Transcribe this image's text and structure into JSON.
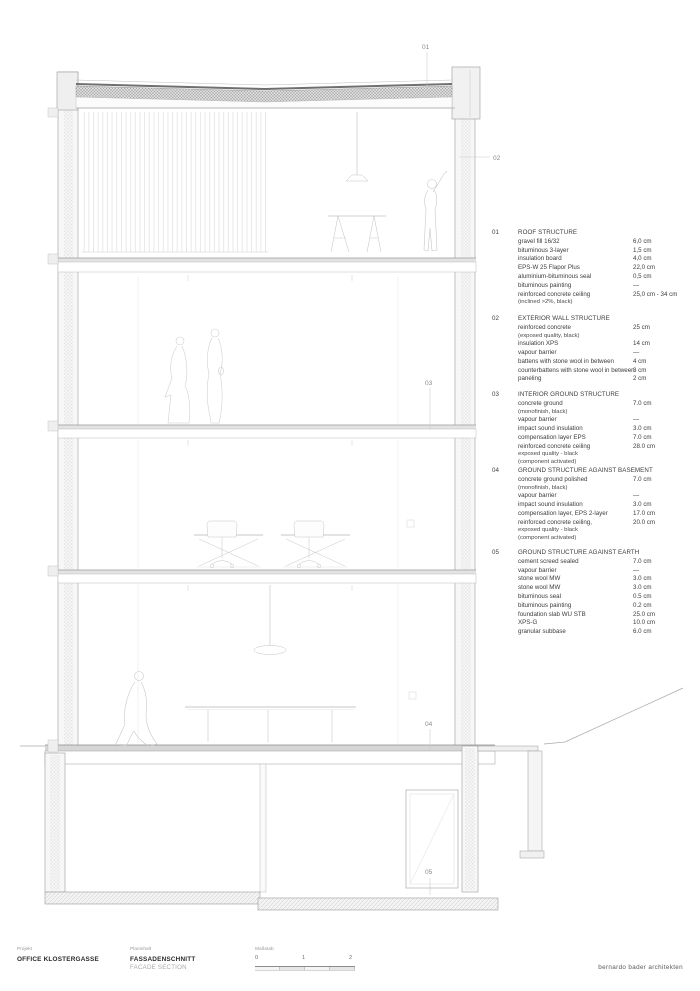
{
  "palette": {
    "ink": "#3a3a3a",
    "line_light": "#c9c9c9",
    "line_mid": "#9b9b9b",
    "slab_fill": "#d6d6d6",
    "roof_fill": "#dcdcdc"
  },
  "drawing": {
    "markers": [
      {
        "id": "01"
      },
      {
        "id": "02"
      },
      {
        "id": "03"
      },
      {
        "id": "04"
      },
      {
        "id": "05"
      }
    ]
  },
  "notes": [
    {
      "number": "01",
      "title": "ROOF STRUCTURE",
      "rows": [
        {
          "label": "gravel fill 16/32",
          "value": "6,0 cm"
        },
        {
          "label": "bituminous 3-layer",
          "value": "1,5 cm"
        },
        {
          "label": "insulation board",
          "value": "4,0 cm"
        },
        {
          "label": "EPS-W 25 Flapor Plus",
          "value": "22,0 cm"
        },
        {
          "label": "aluminium-bituminous seal",
          "value": "0,5 cm"
        },
        {
          "label": "bituminous painting",
          "value": "—"
        },
        {
          "label": "reinforced concrete ceiling",
          "value": "25,0 cm - 34 cm"
        },
        {
          "label": "(inclined >2%, black)",
          "value": ""
        }
      ]
    },
    {
      "number": "02",
      "title": "EXTERIOR WALL STRUCTURE",
      "rows": [
        {
          "label": "reinforced concrete",
          "value": "25 cm"
        },
        {
          "label": "(exposed quality, black)",
          "value": ""
        },
        {
          "label": "insulation XPS",
          "value": "14 cm"
        },
        {
          "label": "vapour barrier",
          "value": "—"
        },
        {
          "label": "battens with stone wool in between",
          "value": "4 cm"
        },
        {
          "label": "counterbattens with stone wool in between",
          "value": "3 cm"
        },
        {
          "label": "paneling",
          "value": "2 cm"
        }
      ]
    },
    {
      "number": "03",
      "title": "INTERIOR GROUND STRUCTURE",
      "rows": [
        {
          "label": "concrete ground",
          "value": "7.0 cm"
        },
        {
          "label": "(monofinish, black)",
          "value": ""
        },
        {
          "label": "vapour barrier",
          "value": "—"
        },
        {
          "label": "impact sound insulation",
          "value": "3.0 cm"
        },
        {
          "label": "compensation layer EPS",
          "value": "7.0 cm"
        },
        {
          "label": "reinforced concrete ceiling",
          "value": "28.0 cm"
        },
        {
          "label": "exposed quality - black",
          "value": ""
        },
        {
          "label": "(component activated)",
          "value": ""
        }
      ]
    },
    {
      "number": "04",
      "title": "GROUND STRUCTURE AGAINST BASEMENT",
      "rows": [
        {
          "label": "concrete ground polished",
          "value": "7.0 cm"
        },
        {
          "label": "(monofinish, black)",
          "value": ""
        },
        {
          "label": "vapour barrier",
          "value": "—"
        },
        {
          "label": "impact sound insulation",
          "value": "3.0 cm"
        },
        {
          "label": "compensation layer, EPS 2-layer",
          "value": "17.0 cm"
        },
        {
          "label": "reinforced concrete ceiling,",
          "value": "20.0 cm"
        },
        {
          "label": "exposed quality - black",
          "value": ""
        },
        {
          "label": "(component activated)",
          "value": ""
        }
      ]
    },
    {
      "number": "05",
      "title": "GROUND STRUCTURE AGAINST EARTH",
      "rows": [
        {
          "label": "cement screed sealed",
          "value": "7.0 cm"
        },
        {
          "label": "vapour barrier",
          "value": "—"
        },
        {
          "label": "stone wool MW",
          "value": "3.0 cm"
        },
        {
          "label": "stone wool MW",
          "value": "3.0 cm"
        },
        {
          "label": "bituminous seal",
          "value": "0.5 cm"
        },
        {
          "label": "bituminous painting",
          "value": "0.2 cm"
        },
        {
          "label": "foundation slab WU STB",
          "value": "25.0 cm"
        },
        {
          "label": "XPS-G",
          "value": "10.0 cm"
        },
        {
          "label": "granular subbase",
          "value": "6.0 cm"
        }
      ]
    }
  ],
  "titleblock": {
    "project_label": "Projekt",
    "project_name": "OFFICE KLOSTERGASSE",
    "sheet_label": "Planinhalt",
    "sheet_title_de": "FASSADENSCHNITT",
    "sheet_title_en": "FACADE SECTION",
    "scale_label": "Maßstab",
    "scale_ticks": [
      "0",
      "1",
      "2"
    ],
    "firm": "bernardo bader architekten"
  }
}
